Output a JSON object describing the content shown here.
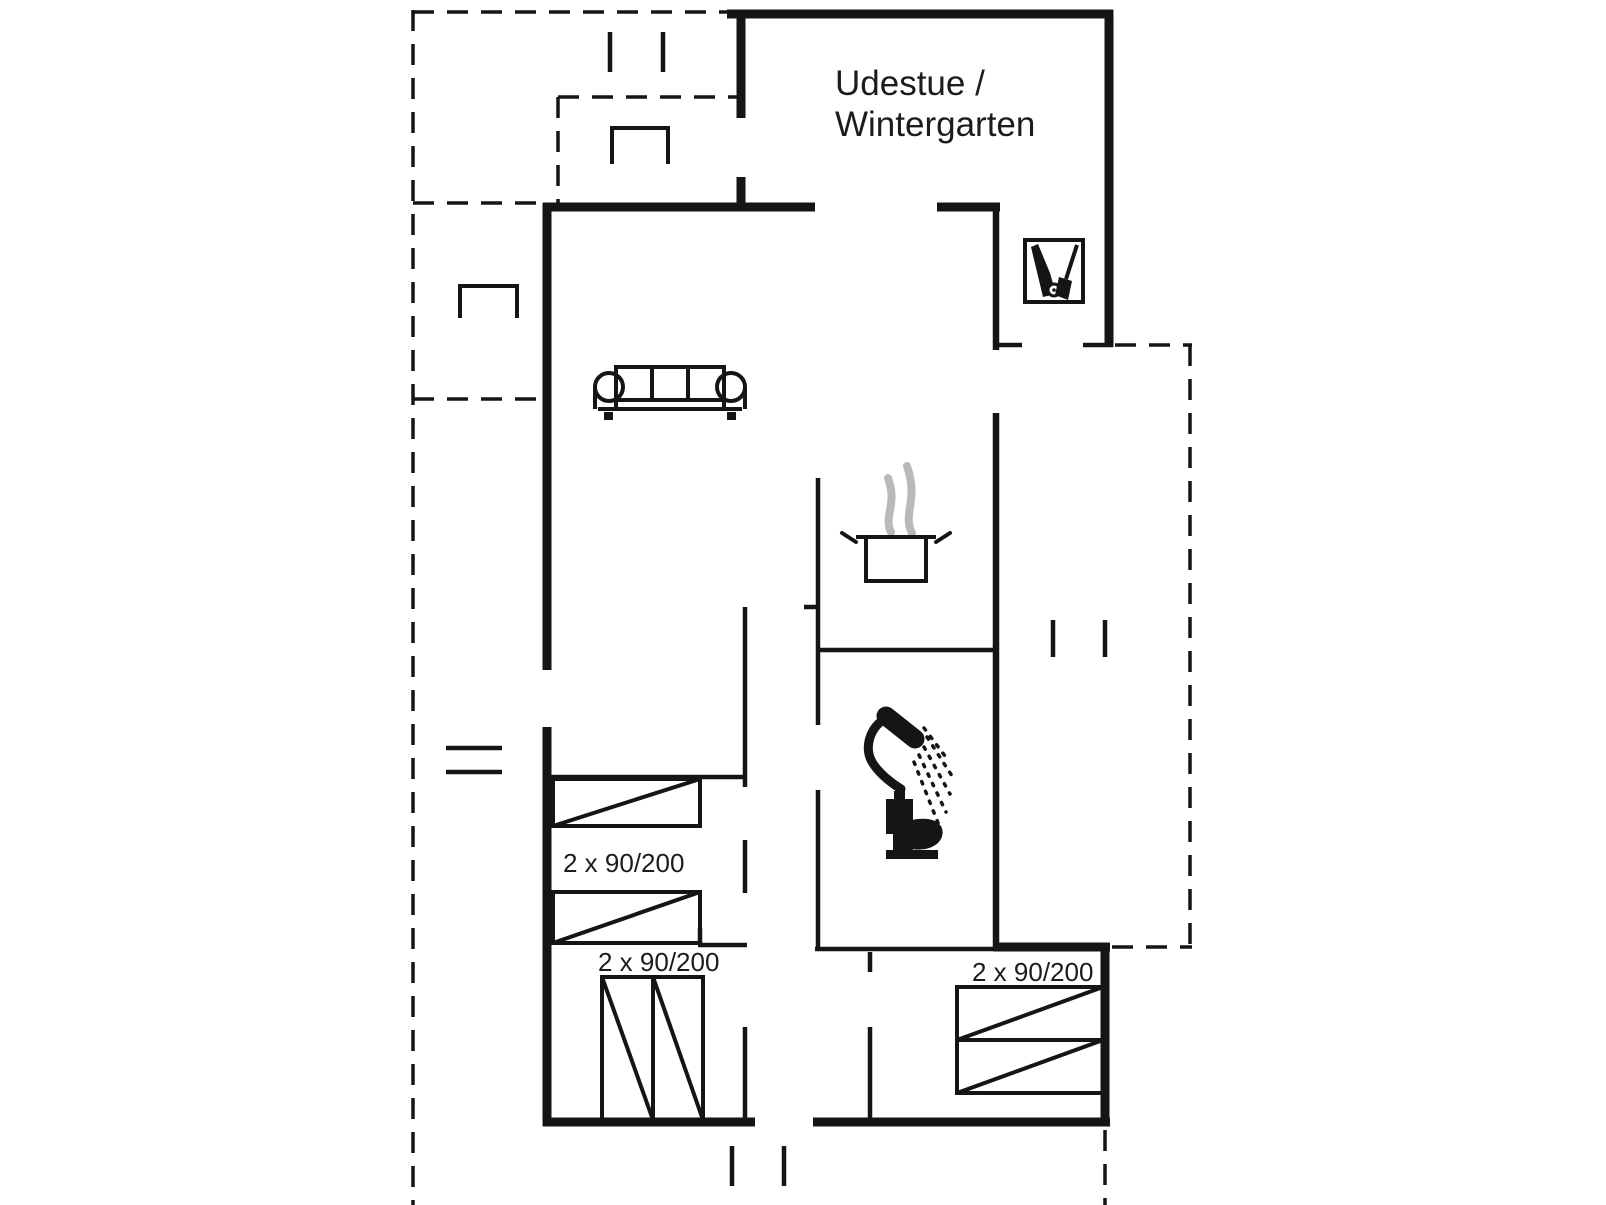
{
  "colors": {
    "background": "#ffffff",
    "line": "#151515",
    "steam": "#b9b9b9",
    "text": "#1c1c1c"
  },
  "floor_plan": {
    "rooms": {
      "winter_garden": {
        "name_line1": "Udestue /",
        "name_line2": "Wintergarten"
      }
    },
    "bed_labels": {
      "left_upper": "2 x 90/200",
      "left_lower": "2 x 90/200",
      "right": "2 x 90/200"
    },
    "icons": [
      "sofa-icon",
      "cooking-pot-icon",
      "steam-icon",
      "shower-icon",
      "toilet-icon",
      "cleaning-closet-icon",
      "garden-table-icon",
      "window-mark",
      "entrance-step-mark"
    ]
  }
}
